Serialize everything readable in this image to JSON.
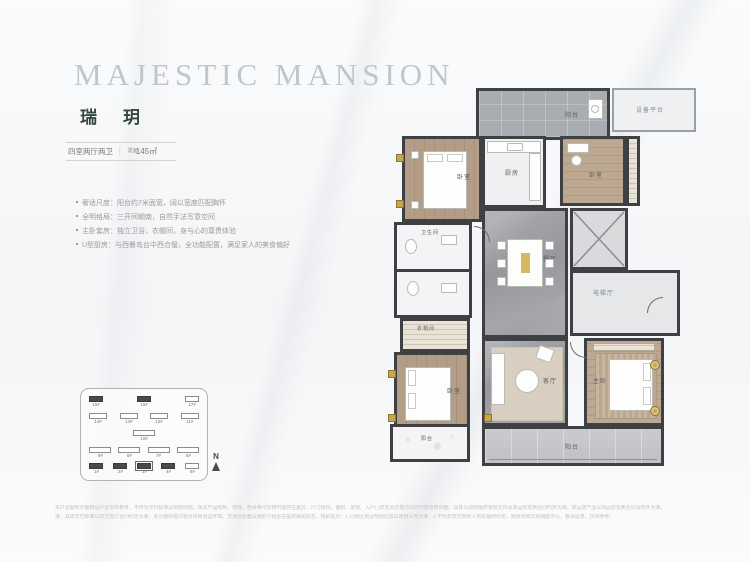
{
  "header": {
    "title": "MAJESTIC MANSION",
    "name": "瑞玥",
    "spec": "四室两厅两卫",
    "divider": "│",
    "area_label": "建面",
    "area_value": "145㎡"
  },
  "features": [
    "奢适尺度：阳台约7米面宽，阔以宽度匹配胸怀",
    "全明格局：三开间朝南，自然手法写意空间",
    "主卧套房：独立卫浴，衣帽间，身与心的尊贵体验",
    "U型厨房：与西餐岛台中西合璧，全功能配置，满足家人的美食偏好"
  ],
  "floorplan": {
    "labels": {
      "balcony_top": "阳台",
      "equipment": "设备平台",
      "bedroom_top_left": "卧室",
      "kitchen": "厨房",
      "bedroom_top_right": "卧室",
      "dining": "餐厅",
      "elevator_hall": "电梯厅",
      "bathroom": "卫生间",
      "closet": "衣帽间",
      "bedroom_bottom_left": "卧室",
      "living": "客厅",
      "master": "主卧",
      "balcony_bottom": "阳台",
      "balcony_side": "阳台"
    }
  },
  "siteplan": {
    "rows": [
      [
        {
          "label": "15#",
          "style": "dark"
        },
        {
          "label": "16#",
          "style": "dark"
        },
        {
          "label": "17#",
          "style": "light"
        }
      ],
      [
        {
          "label": "14#",
          "style": "light"
        },
        {
          "label": "13#",
          "style": "light"
        },
        {
          "label": "12#",
          "style": "light"
        },
        {
          "label": "11#",
          "style": "light"
        }
      ],
      [
        {
          "label": "10#",
          "style": "light"
        }
      ],
      [
        {
          "label": "9#",
          "style": "light"
        },
        {
          "label": "8#",
          "style": "light"
        },
        {
          "label": "7#",
          "style": "light"
        },
        {
          "label": "6#",
          "style": "light"
        }
      ],
      [
        {
          "label": "1#",
          "style": "dark"
        },
        {
          "label": "2#",
          "style": "dark"
        },
        {
          "label": "3#",
          "style": "current"
        },
        {
          "label": "4#",
          "style": "dark"
        },
        {
          "label": "5#",
          "style": "light"
        }
      ]
    ],
    "compass_label": "N"
  },
  "disclaimer": [
    "本户型图所示面积及户型仅供参考，不作为交付标准及购房依据，相关产品结构、墙体、色泽等与实物可能存在差异，尺寸结构、面积、景观、入户门样式及示意方向均可能有所调整，具体以政府最终审批文件及商品房买卖合同约定为准，高品质产品以商品房买卖合同及附件为准。",
    "准，具体交付标准以双方签订合同约定为准，本页面所载内容对项目周边环境、交通及配套设施的介绍旨在提供相关信息，特别提示：1.行政区划及规划信息以政府公布为准；2.不代表双方权利义务的最终约定，购房须知详询销售中心，敬请留意，仅供参考。"
  ],
  "colors": {
    "accent_gold": "#c9a84c",
    "wall": "#3e4044",
    "brand_green": "#35463b",
    "title_gray": "#c2c6c8"
  }
}
